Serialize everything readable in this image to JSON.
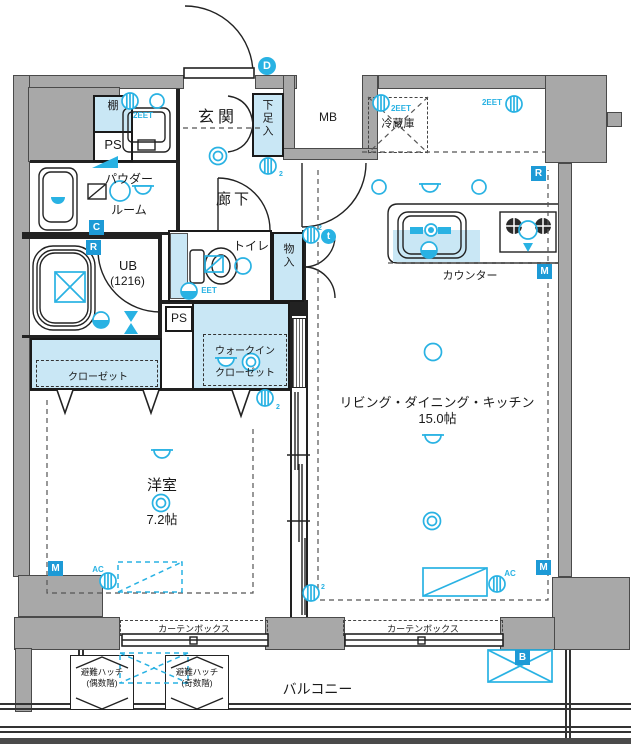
{
  "fp": {
    "rooms": {
      "genkan": "玄関",
      "shoebox": "下足入",
      "hall": "廊下",
      "toilet": "トイレ",
      "storage": "物入",
      "powder1": "パウダー",
      "powder2": "ルーム",
      "ub1": "UB",
      "ub2": "(1216)",
      "ps": "PS",
      "shelf": "棚",
      "mb": "MB",
      "fridge": "冷蔵庫",
      "counter": "カウンター",
      "wic1": "ウォークイン",
      "wic2": "クローゼット",
      "closet": "クローゼット",
      "bedroom": "洋室",
      "bedroom_size": "7.2帖",
      "ldk": "リビング・ダイニング・キッチン",
      "ldk_size": "15.0帖",
      "balcony": "バルコニー",
      "curtain_box": "カーテンボックス",
      "hatch_even1": "避難ハッチ",
      "hatch_even2": "(偶数階)",
      "hatch_odd1": "避難ハッチ",
      "hatch_odd2": "(奇数階)"
    },
    "markers": {
      "c": "C",
      "r": "R",
      "m": "M",
      "b": "B",
      "d": "D",
      "t": "t"
    },
    "sym": {
      "eet2": "2EET",
      "eet": "EET",
      "ac": "AC",
      "two": "2"
    },
    "colors": {
      "wall": "#a8a8a8",
      "closet_fill": "#c9e7f5",
      "symbol_cyan": "#29b2e3",
      "marker_blue": "#1d9ad6"
    }
  }
}
